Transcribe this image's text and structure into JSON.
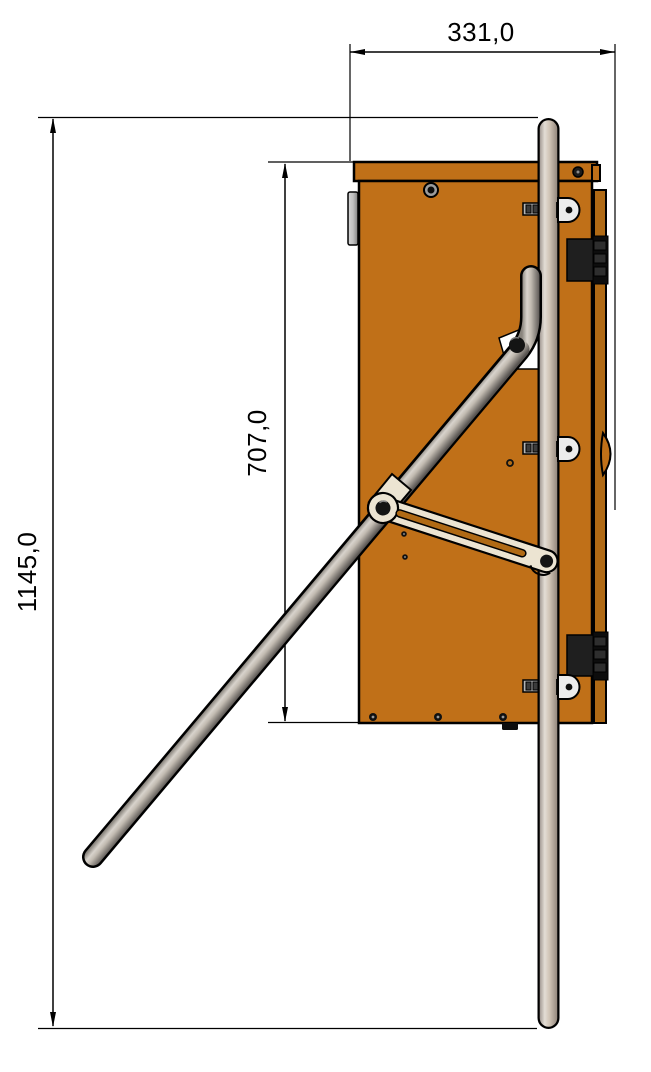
{
  "drawing": {
    "type": "technical-drawing-side-view",
    "dimensions": {
      "top_width_label": "331,0",
      "cabinet_height_label": "707,0",
      "overall_height_label": "1145,0"
    },
    "colors": {
      "background": "#ffffff",
      "cabinet_orange": "#c07018",
      "door_edge_orange": "#b06a15",
      "outline_black": "#000000",
      "hinge_black": "#141414",
      "metal_highlight": "#e2dcd4",
      "metal_shadow": "#6e6862",
      "bracket_cream": "#ece4d2",
      "tab_gray": "#ececec"
    },
    "parts": {
      "cabinet": "cabinet",
      "lid": "lid",
      "door_edge": "door-edge",
      "hinge_top": "hinge-top",
      "hinge_bottom": "hinge-bottom",
      "pole": "guide-pole",
      "arm": "turnstile-arm",
      "linkage": "slotted-linkage",
      "wall_bracket": "wall-bracket"
    }
  }
}
